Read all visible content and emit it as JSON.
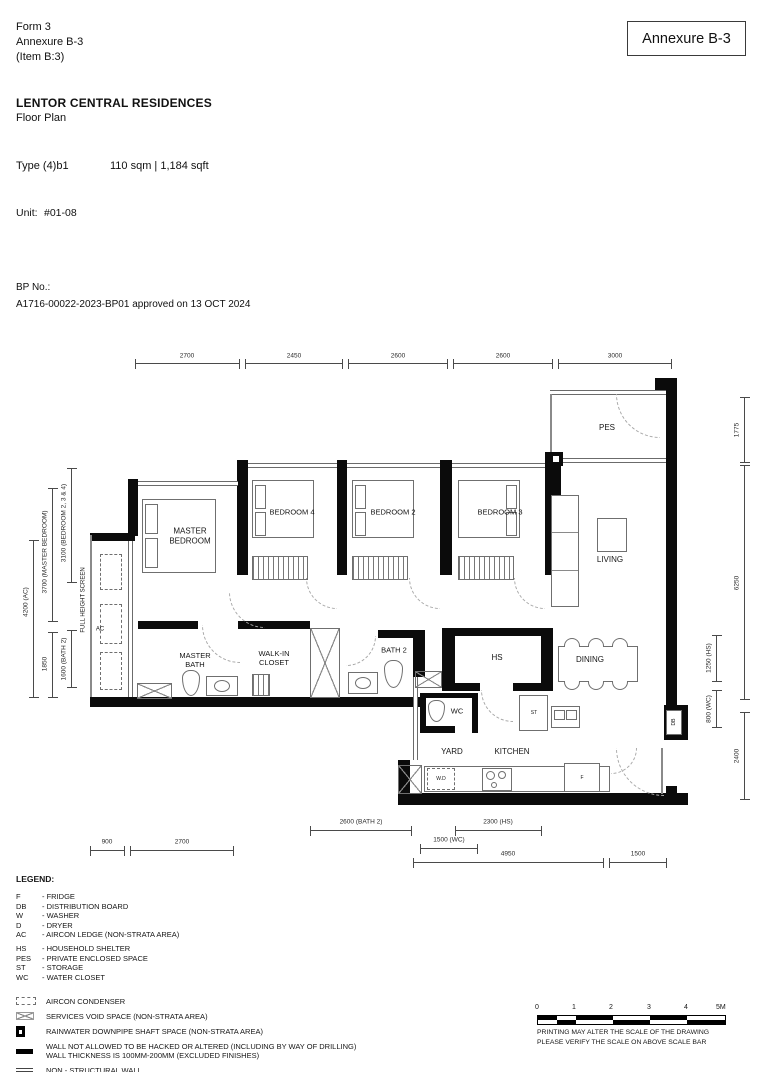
{
  "header": {
    "form_lines": "Form 3\nAnnexure B-3\n(Item B:3)",
    "annexure_box": "Annexure B-3",
    "project_name": "LENTOR CENTRAL RESIDENCES",
    "subtitle": "Floor Plan",
    "type_label": "Type (4)b1",
    "area_label": "110 sqm | 1,184 sqft",
    "unit_label": "Unit:",
    "unit_value": "#01-08",
    "bp_label": "BP No.:",
    "bp_value": "A1716-00022-2023-BP01 approved on 13 OCT 2024"
  },
  "plan": {
    "labels": {
      "pes": "PES",
      "living": "LIVING",
      "dining": "DINING",
      "master_bedroom": "MASTER\nBEDROOM",
      "bedroom4": "BEDROOM 4",
      "bedroom2": "BEDROOM 2",
      "bedroom3": "BEDROOM 3",
      "master_bath": "MASTER\nBATH",
      "walk_in_closet": "WALK-IN\nCLOSET",
      "bath2": "BATH 2",
      "hs": "HS",
      "wc": "WC",
      "yard": "YARD",
      "kitchen": "KITCHEN",
      "st": "ST",
      "wd": "W.D",
      "fridge": "F",
      "db": "DB",
      "ac": "AC",
      "full_height_screen": "FULL HEIGHT SCREEN"
    },
    "dims": {
      "top": [
        "2700",
        "2450",
        "2600",
        "2600",
        "3000"
      ],
      "left": [
        "4200 (AC)",
        "3700 (MASTER BEDROOM)",
        "3100 (BEDROOM 2, 3 & 4)",
        "1850",
        "1600 (BATH 2)"
      ],
      "right": [
        "1775",
        "6250",
        "1250 (HS)",
        "800 (WC)",
        "2400"
      ],
      "bottom": [
        "2600 (BATH 2)",
        "2300 (HS)",
        "1500 (WC)",
        "900",
        "2700",
        "4950",
        "1500"
      ]
    }
  },
  "legend": {
    "title": "LEGEND:",
    "abbreviations": [
      {
        "abbr": "F",
        "desc": "- FRIDGE"
      },
      {
        "abbr": "DB",
        "desc": "- DISTRIBUTION BOARD"
      },
      {
        "abbr": "W",
        "desc": "- WASHER"
      },
      {
        "abbr": "D",
        "desc": "- DRYER"
      },
      {
        "abbr": "AC",
        "desc": "- AIRCON LEDGE (NON-STRATA AREA)"
      },
      {
        "abbr": "HS",
        "desc": "- HOUSEHOLD SHELTER"
      },
      {
        "abbr": "PES",
        "desc": "- PRIVATE ENCLOSED SPACE"
      },
      {
        "abbr": "ST",
        "desc": "- STORAGE"
      },
      {
        "abbr": "WC",
        "desc": "- WATER CLOSET"
      }
    ],
    "symbols": [
      {
        "label": "AIRCON CONDENSER"
      },
      {
        "label": "SERVICES VOID SPACE (NON-STRATA AREA)"
      },
      {
        "label": "RAINWATER DOWNPIPE SHAFT SPACE (NON-STRATA AREA)"
      },
      {
        "label": "WALL NOT ALLOWED TO BE HACKED OR ALTERED (INCLUDING BY WAY OF DRILLING)\nWALL THICKNESS IS 100MM-200MM (EXCLUDED FINISHES)"
      },
      {
        "label": "NON - STRUCTURAL WALL"
      }
    ]
  },
  "scalebar": {
    "ticks": [
      "0",
      "1",
      "2",
      "3",
      "4",
      "5M"
    ],
    "notes": "PRINTING MAY ALTER THE SCALE OF THE DRAWING\nPLEASE VERIFY THE SCALE ON ABOVE SCALE BAR"
  }
}
